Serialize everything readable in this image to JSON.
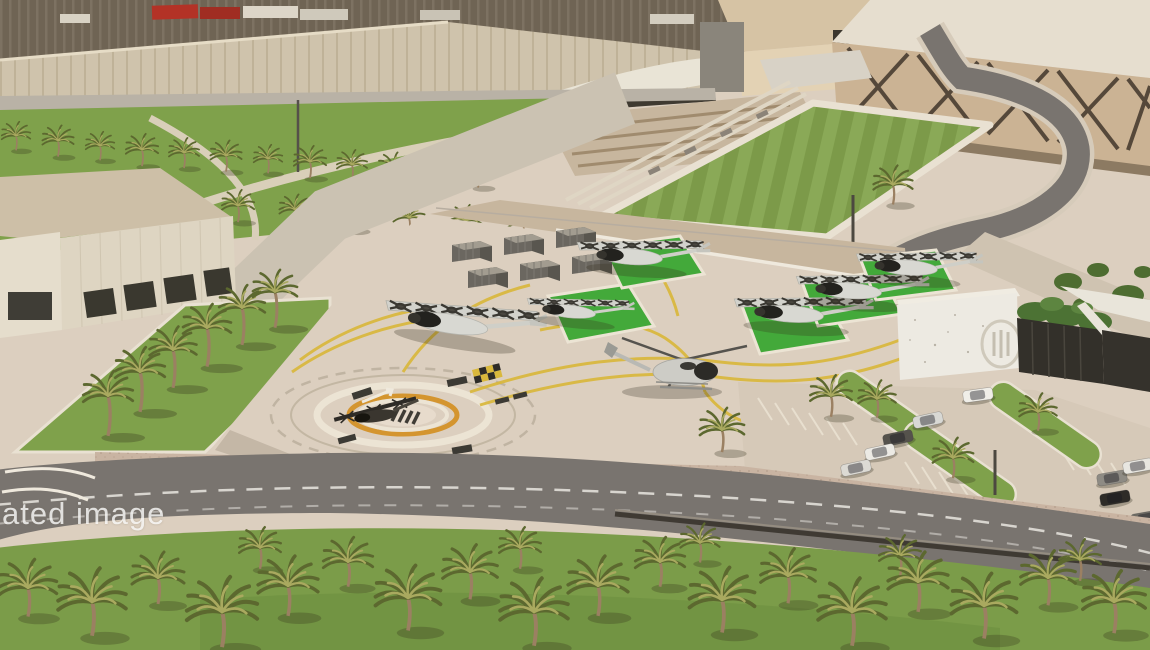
{
  "watermark": {
    "text": "ated image"
  },
  "scene": {
    "kind": "aerial-photo",
    "subject": "vertiport apron with eVTOL aircraft and helicopter beside industrial warehouses",
    "objects": {
      "evtol_aircraft_count": 7,
      "helicopter_count": 1,
      "helipad_count": 1,
      "cargo_container_count": 6,
      "parked_car_count": 9
    }
  },
  "colors": {
    "apron": "#dccfbf",
    "apron_light": "#e7dbcc",
    "grass": "#7fa14b",
    "field_green": "#7c9a49",
    "field_green2": "#8aa957",
    "pad_green": "#43a93a",
    "road_light": "#cbc2b2",
    "asphalt": "#79746f",
    "asphalt_dark": "#5f5b57",
    "sidewalk": "#c9b4a2",
    "roof_brown": "#6f6454",
    "roof_rib": "#7d7262",
    "canopy": "#cfc3ac",
    "canopy_white": "#e9e4d6",
    "wall_beige": "#cbb394",
    "brace_dark": "#55483a",
    "building_white": "#ded5c2",
    "glass_dark": "#33302a",
    "terminal_white": "#edeae2",
    "dirt": "#c7b69e",
    "helipad_orange": "#d4952f",
    "taxi_yellow": "#d9b83c",
    "line_white": "#ece4d4",
    "palm_dark": "#5c682f",
    "palm_light": "#a9a95f",
    "trunk": "#9b8062"
  }
}
